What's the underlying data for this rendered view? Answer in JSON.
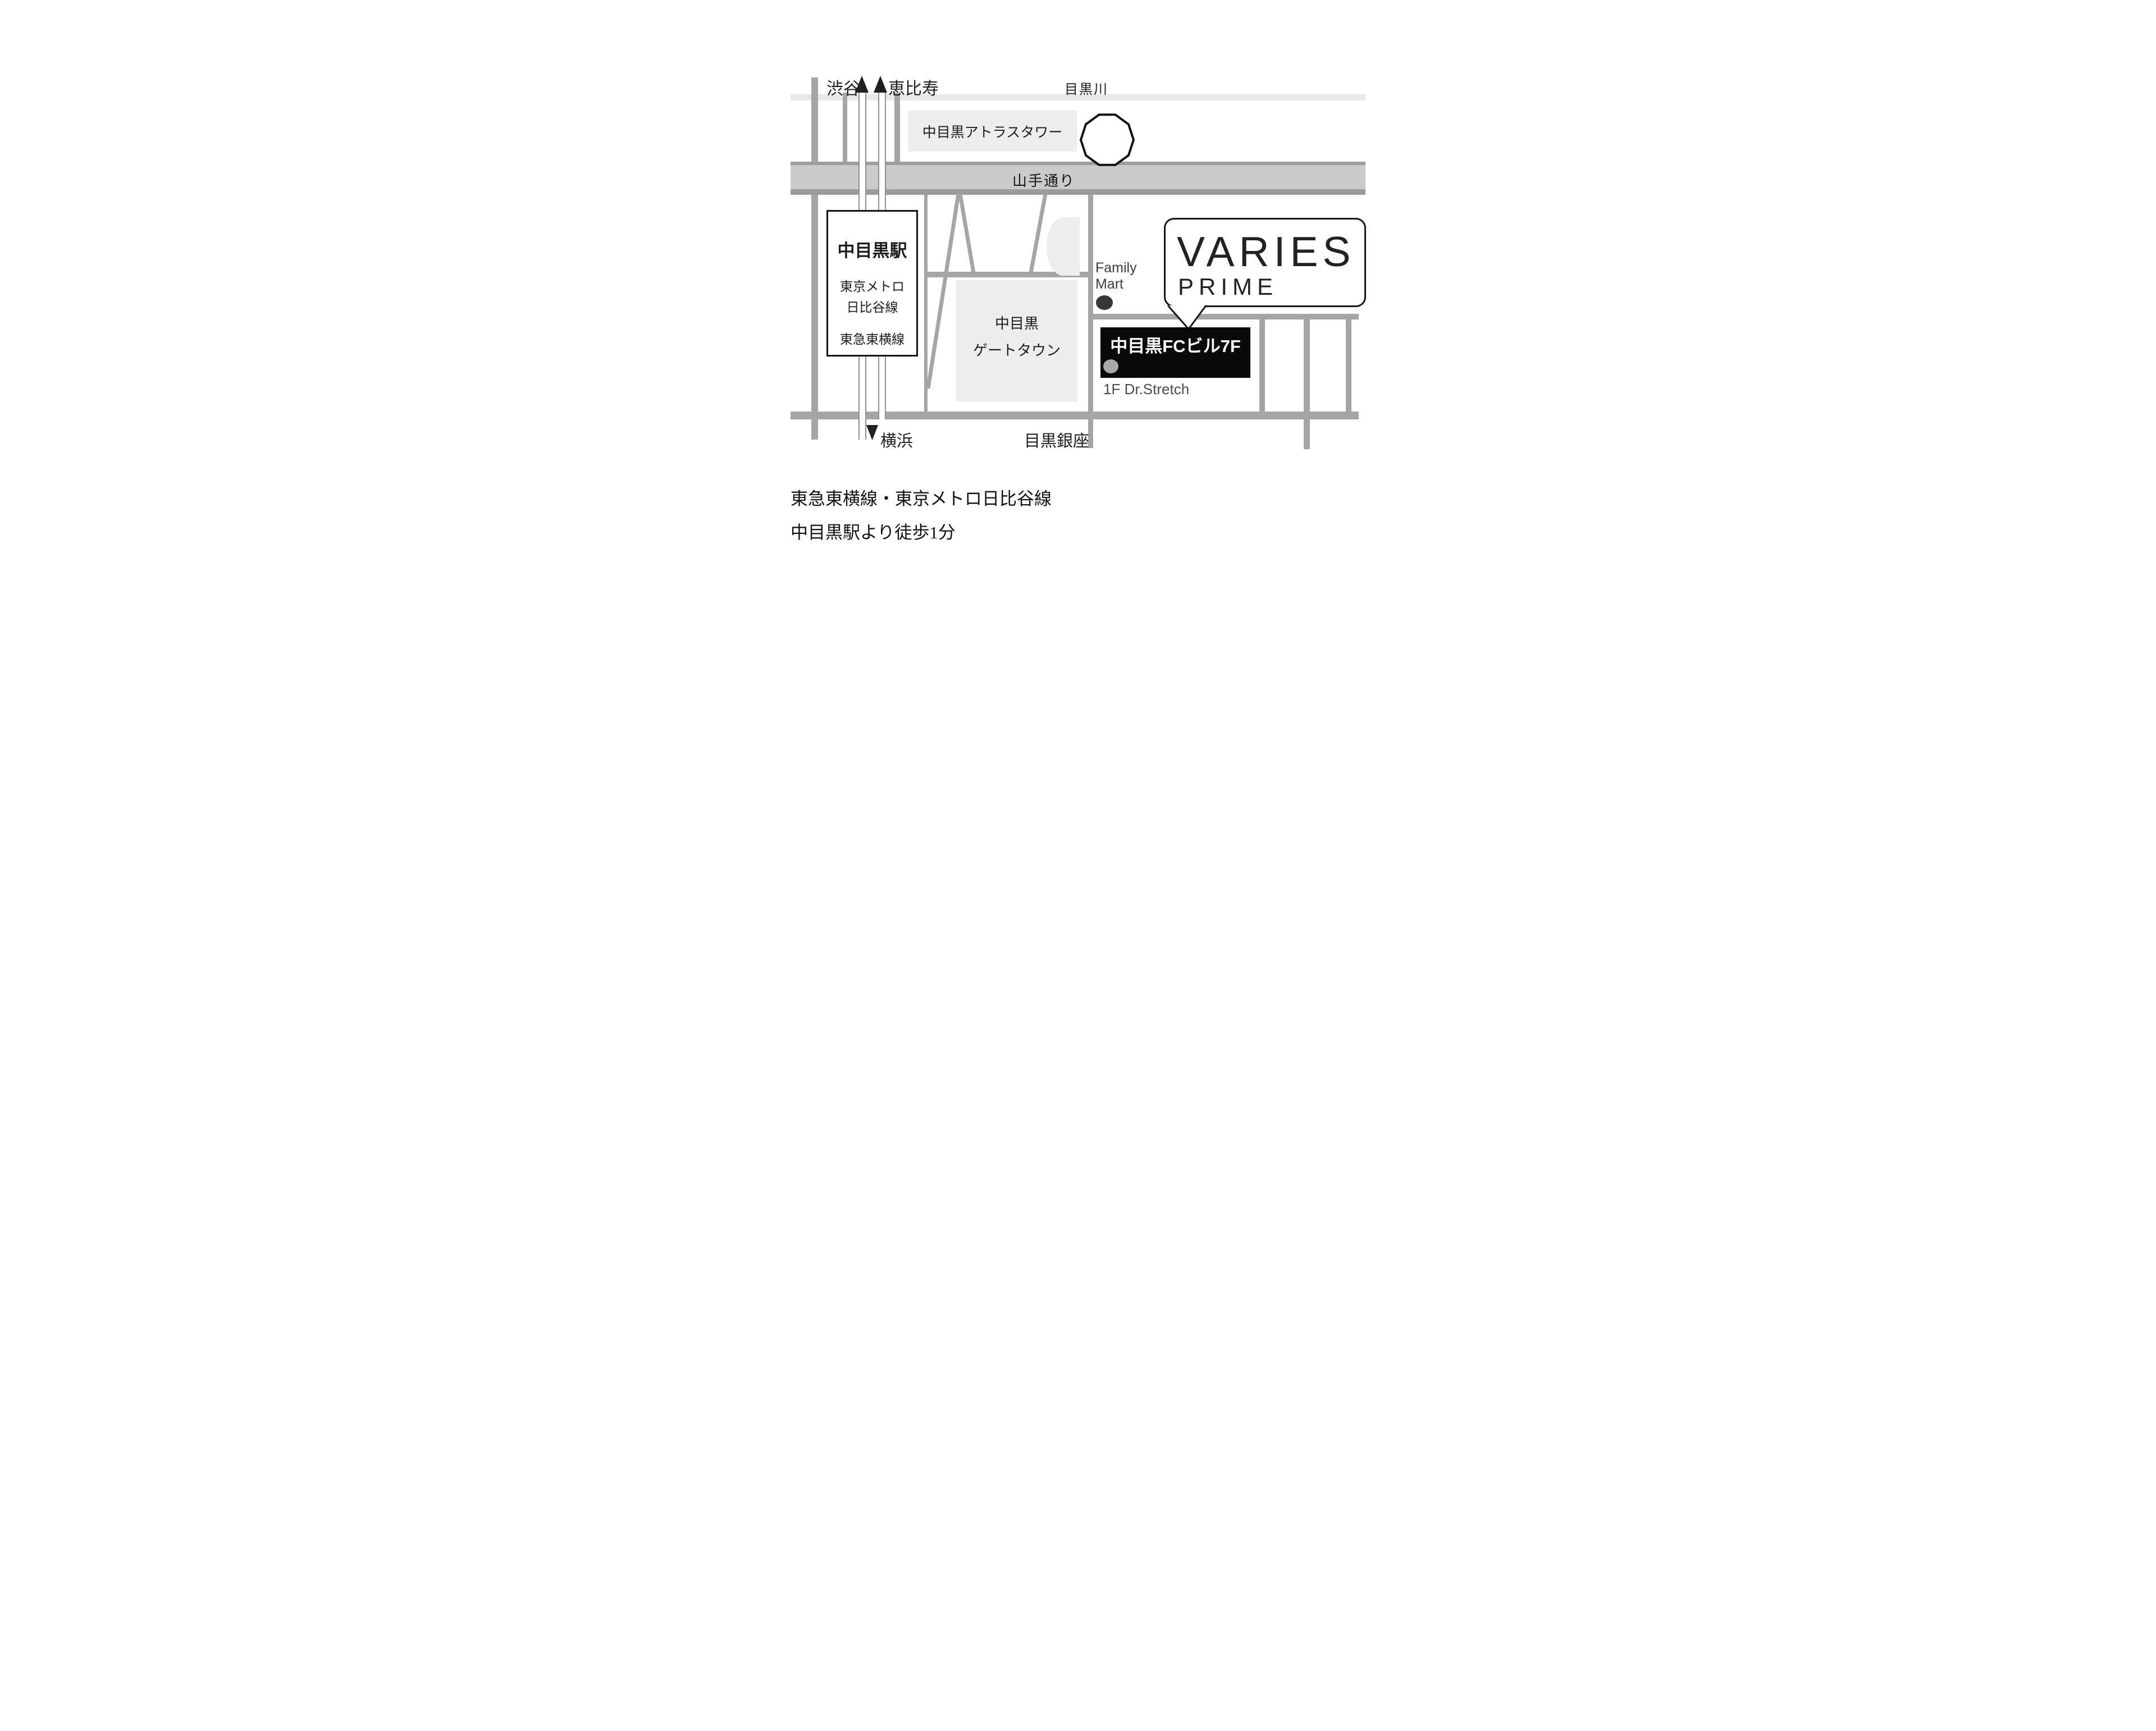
{
  "map": {
    "title": "VARIES PRIME access map",
    "labels": {
      "shibuya": "渋谷",
      "ebisu": "恵比寿",
      "meguro_river": "目黒川",
      "atlas_tower": "中目黒アトラスタワー",
      "yamate_dori": "山手通り",
      "station_name": "中目黒駅",
      "station_line_1": "東京メトロ",
      "station_line_2": "日比谷線",
      "station_line_3": "東急東横線",
      "gate_town_1": "中目黒",
      "gate_town_2": "ゲートタウン",
      "family_mart_1": "Family",
      "family_mart_2": "Mart",
      "varies": "VARIES",
      "prime": "PRIME",
      "fc_building": "中目黒FCビル7F",
      "dr_stretch": "1F Dr.Stretch",
      "yokohama": "横浜",
      "meguro_ginza": "目黒銀座"
    },
    "captions": [
      "東急東横線・東京メトロ日比谷線",
      "中目黒駅より徒歩1分"
    ],
    "icons": {
      "direction_up": "filled triangle pointing up (train direction to Shibuya / Ebisu)",
      "direction_down": "filled triangle pointing down (train direction to Yokohama)",
      "family_mart_dot": "dark location dot",
      "fc_building_dot": "gray location dot",
      "pond": "decagon outline on Meguro river"
    },
    "colors": {
      "background": "#ffffff",
      "light_road": "#e9e9e9",
      "building_fill": "#ededed",
      "yamate_fill": "#cbcbcb",
      "yamate_edge": "#9c9c9c",
      "road": "#a5a5a5",
      "rail_line": "#8f8f8f",
      "outline_black": "#151515",
      "fc_box_black": "#0a0a0a",
      "text_dark": "#1f1f1f",
      "family_text": "#3e3e3e",
      "stretch_text": "#4c4c4c",
      "fc_dot": "#a8a8a8",
      "family_dot": "#383838"
    }
  }
}
